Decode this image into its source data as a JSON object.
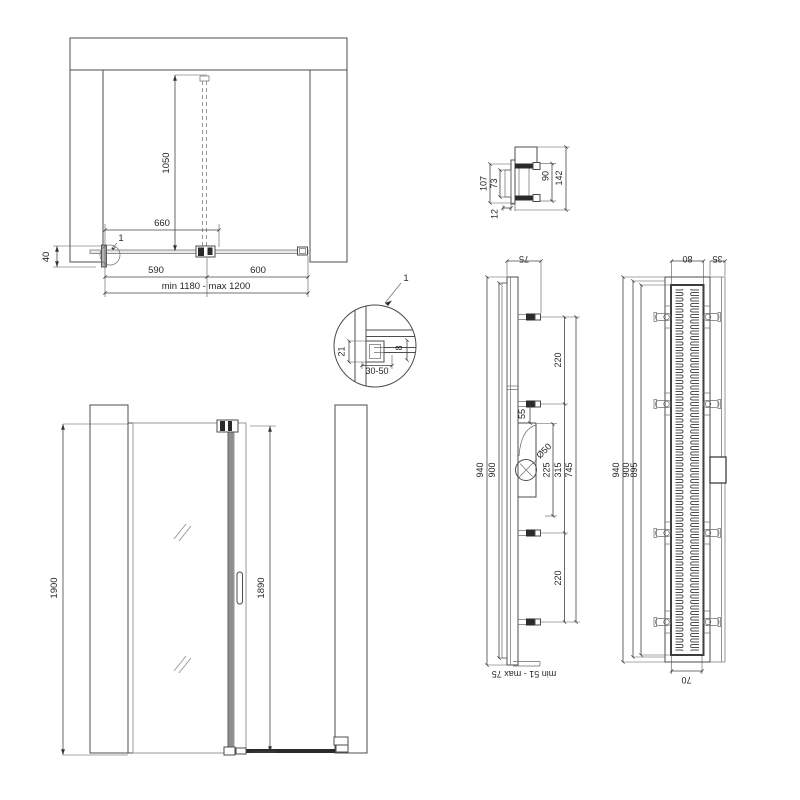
{
  "plan_view": {
    "callout": "1",
    "dim_height": "1050",
    "dim_fixed_assembly": "660",
    "dim_fixed": "590",
    "dim_door": "600",
    "dim_total": "min 1180 - max 1200",
    "dim_wall_offset": "40"
  },
  "profile_detail": {
    "callout": "1",
    "dim_profile_depth": "21",
    "dim_adjust_range": "30-50",
    "dim_glass_thickness": "8"
  },
  "bracket_detail": {
    "dim_outer": "107",
    "dim_inner": "73",
    "dim_upper": "90",
    "dim_total": "142",
    "dim_plate": "12"
  },
  "front_view": {
    "dim_total_height": "1900",
    "dim_glass_height": "1890"
  },
  "channel_side_view": {
    "dim_depth": "75",
    "dim_length_outer": "940",
    "dim_length_inner": "900",
    "dim_bracket_gap_upper": "220",
    "dim_trap_offset": "55",
    "dim_trap_height": "225",
    "dim_bracket_mid_gap": "315",
    "dim_bracket_span": "745",
    "dim_pipe_diameter": "Ø50",
    "dim_bracket_gap_lower": "220",
    "dim_foot_range": "min 51 - max 75"
  },
  "channel_top_view": {
    "dim_body_width": "80",
    "dim_flange_width": "35",
    "dim_length_outer": "940",
    "dim_length_inner": "900",
    "dim_grate_length": "895",
    "dim_grate_width": "70"
  }
}
